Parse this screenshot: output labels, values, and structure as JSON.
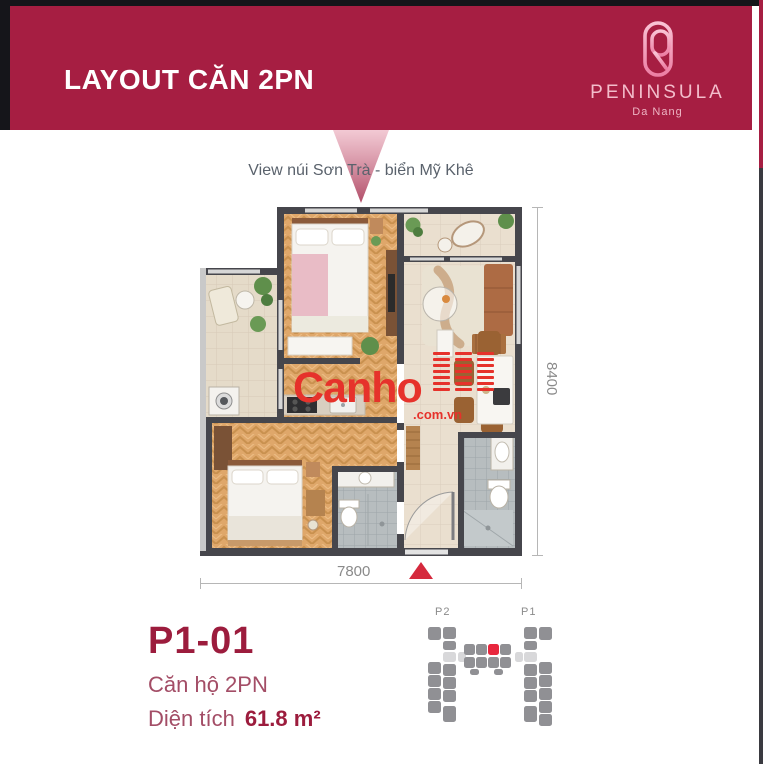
{
  "header": {
    "title": "LAYOUT CĂN 2PN",
    "brand_name": "PENINSULA",
    "brand_location": "Da Nang"
  },
  "view_label": "View núi Sơn Trà - biển Mỹ Khê",
  "floor_plan": {
    "dim_width": "7800",
    "dim_height": "8400"
  },
  "watermark": {
    "name": "Canho",
    "suffix": ".com.vn",
    "bars_rows": 7,
    "bars_cols": 3
  },
  "unit": {
    "code": "P1-01",
    "type_label": "Căn hộ 2PN",
    "area_label": "Diện tích",
    "area_value": "61.8 m²"
  },
  "minimap": {
    "label_p2": "P2",
    "label_p1": "P1",
    "units": [
      {
        "x": 6,
        "y": 27,
        "w": 13,
        "h": 13,
        "c": "g"
      },
      {
        "x": 6,
        "y": 62,
        "w": 13,
        "h": 12,
        "c": "g"
      },
      {
        "x": 6,
        "y": 75,
        "w": 13,
        "h": 12,
        "c": "g"
      },
      {
        "x": 6,
        "y": 88,
        "w": 13,
        "h": 12,
        "c": "g"
      },
      {
        "x": 6,
        "y": 101,
        "w": 13,
        "h": 12,
        "c": "g"
      },
      {
        "x": 21,
        "y": 27,
        "w": 13,
        "h": 12,
        "c": "g"
      },
      {
        "x": 21,
        "y": 41,
        "w": 13,
        "h": 9,
        "c": "g"
      },
      {
        "x": 21,
        "y": 52,
        "w": 13,
        "h": 10,
        "c": "l"
      },
      {
        "x": 21,
        "y": 64,
        "w": 13,
        "h": 12,
        "c": "g"
      },
      {
        "x": 21,
        "y": 77,
        "w": 13,
        "h": 12,
        "c": "g"
      },
      {
        "x": 21,
        "y": 90,
        "w": 13,
        "h": 12,
        "c": "g"
      },
      {
        "x": 21,
        "y": 106,
        "w": 13,
        "h": 16,
        "c": "g"
      },
      {
        "x": 36,
        "y": 52,
        "w": 8,
        "h": 10,
        "c": "l"
      },
      {
        "x": 93,
        "y": 52,
        "w": 8,
        "h": 10,
        "c": "l"
      },
      {
        "x": 42,
        "y": 44,
        "w": 11,
        "h": 11,
        "c": "g"
      },
      {
        "x": 54,
        "y": 44,
        "w": 11,
        "h": 11,
        "c": "g"
      },
      {
        "x": 66,
        "y": 44,
        "w": 11,
        "h": 11,
        "c": "r"
      },
      {
        "x": 78,
        "y": 44,
        "w": 11,
        "h": 11,
        "c": "g"
      },
      {
        "x": 42,
        "y": 57,
        "w": 11,
        "h": 11,
        "c": "g"
      },
      {
        "x": 54,
        "y": 57,
        "w": 11,
        "h": 11,
        "c": "g"
      },
      {
        "x": 66,
        "y": 57,
        "w": 11,
        "h": 11,
        "c": "g"
      },
      {
        "x": 78,
        "y": 57,
        "w": 11,
        "h": 11,
        "c": "g"
      },
      {
        "x": 48,
        "y": 69,
        "w": 9,
        "h": 6,
        "c": "g"
      },
      {
        "x": 72,
        "y": 69,
        "w": 9,
        "h": 6,
        "c": "g"
      },
      {
        "x": 102,
        "y": 27,
        "w": 13,
        "h": 12,
        "c": "g"
      },
      {
        "x": 102,
        "y": 41,
        "w": 13,
        "h": 9,
        "c": "g"
      },
      {
        "x": 102,
        "y": 52,
        "w": 13,
        "h": 10,
        "c": "l"
      },
      {
        "x": 102,
        "y": 64,
        "w": 13,
        "h": 12,
        "c": "g"
      },
      {
        "x": 102,
        "y": 77,
        "w": 13,
        "h": 12,
        "c": "g"
      },
      {
        "x": 102,
        "y": 90,
        "w": 13,
        "h": 12,
        "c": "g"
      },
      {
        "x": 102,
        "y": 106,
        "w": 13,
        "h": 16,
        "c": "g"
      },
      {
        "x": 117,
        "y": 27,
        "w": 13,
        "h": 13,
        "c": "g"
      },
      {
        "x": 117,
        "y": 62,
        "w": 13,
        "h": 12,
        "c": "g"
      },
      {
        "x": 117,
        "y": 75,
        "w": 13,
        "h": 12,
        "c": "g"
      },
      {
        "x": 117,
        "y": 88,
        "w": 13,
        "h": 12,
        "c": "g"
      },
      {
        "x": 117,
        "y": 101,
        "w": 13,
        "h": 12,
        "c": "g"
      },
      {
        "x": 117,
        "y": 114,
        "w": 13,
        "h": 12,
        "c": "g"
      }
    ]
  },
  "colors": {
    "banner": "#a61e42",
    "brand_pink": "#f3bdcb",
    "watermark_red": "#e6322b",
    "highlight_red": "#e8273e",
    "marker_red": "#d5293d",
    "unit_code_red": "#9c1c3d",
    "unit_text_rose": "#a34d66",
    "dim_gray": "#8a8a8a",
    "wall_dark": "#46464c"
  }
}
